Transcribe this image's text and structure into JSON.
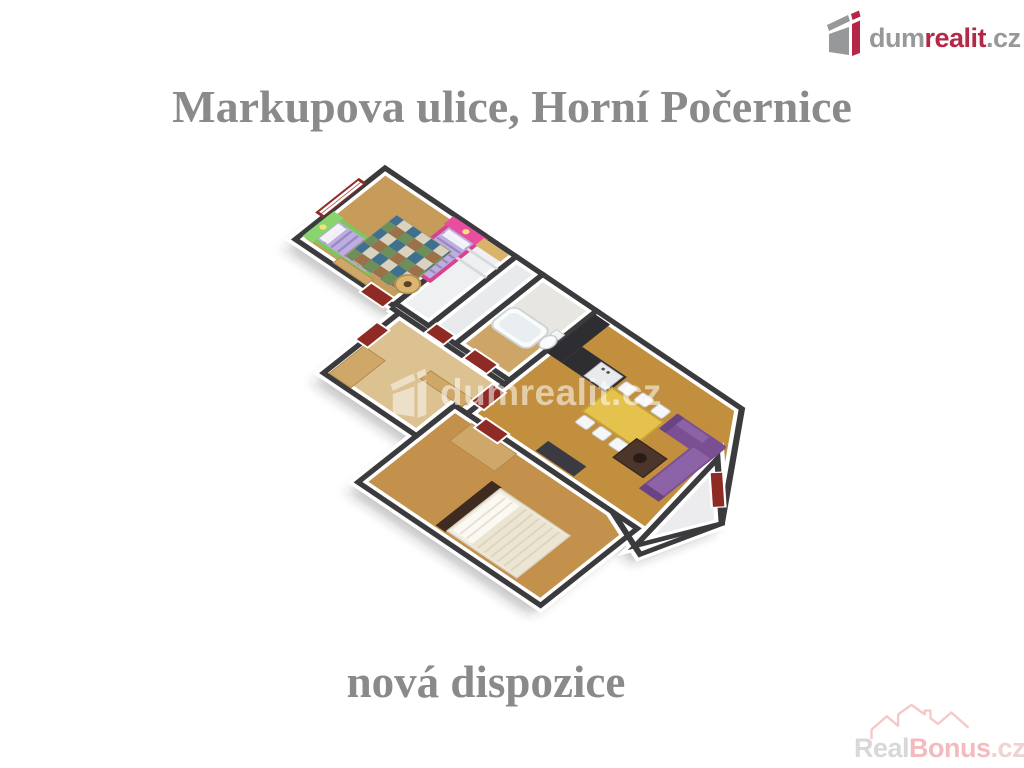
{
  "header": {
    "logo": {
      "prefix": "dum",
      "accent": "realit",
      "suffix": ".cz"
    }
  },
  "title": "Markupova ulice, Horní Počernice",
  "caption": "nová dispozice",
  "watermarks": {
    "plan": "dumrealit.cz",
    "corner": {
      "prefix": "Real",
      "accent": "Bonus",
      "suffix": ".cz"
    }
  },
  "palette": {
    "title_gray": "#8a8a8a",
    "logo_gray": "#96989a",
    "logo_red": "#b42747",
    "wall_top": "#3b3b3e",
    "wall_face": "#ffffff",
    "door_red": "#8e2b24",
    "floor_kids": "#c79c5a",
    "floor_living": "#c28f3e",
    "floor_hall": "#dcc191",
    "floor_bedroom": "#c3914b",
    "floor_balcony": "#ececee",
    "kitchen_dark": "#2e2e32",
    "sofa_purple": "#7b5093",
    "table_yellow": "#e5c24e",
    "kid_mattress_purple": "#bcaede",
    "headboard_pink": "#e84da0",
    "headboard_green": "#8ad46e",
    "wood_furniture": "#cfa768"
  }
}
